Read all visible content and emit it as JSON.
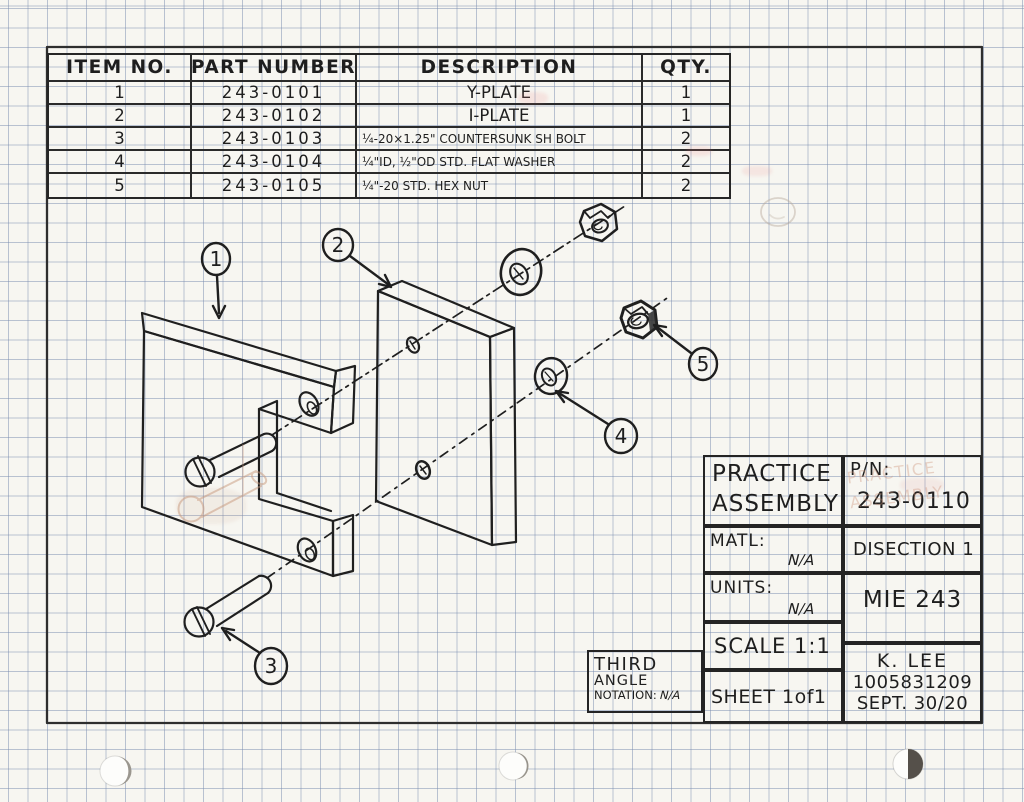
{
  "parts_table": {
    "headers": {
      "item": "ITEM NO.",
      "part": "PART NUMBER",
      "desc": "DESCRIPTION",
      "qty": "QTY."
    },
    "rows": [
      {
        "item": "1",
        "part": "243-0101",
        "desc": "Y-PLATE",
        "qty": "1"
      },
      {
        "item": "2",
        "part": "243-0102",
        "desc": "I-PLATE",
        "qty": "1"
      },
      {
        "item": "3",
        "part": "243-0103",
        "desc": "¼-20×1.25\" COUNTERSUNK SH BOLT",
        "qty": "2"
      },
      {
        "item": "4",
        "part": "243-0104",
        "desc": "¼\"ID, ½\"OD STD. FLAT WASHER",
        "qty": "2"
      },
      {
        "item": "5",
        "part": "243-0105",
        "desc": "¼\"-20 STD. HEX NUT",
        "qty": "2"
      }
    ]
  },
  "title_block": {
    "title_line1": "PRACTICE",
    "title_line2": "ASSEMBLY",
    "pn_label": "P/N:",
    "pn_value": "243-0110",
    "matl_label": "MATL:",
    "matl_value": "N/A",
    "section": "DISECTION 1",
    "units_label": "UNITS:",
    "units_value": "N/A",
    "course": "MIE 243",
    "scale": "SCALE 1:1",
    "sheet": "SHEET 1of1",
    "author": "K. LEE",
    "student_id": "1005831209",
    "date": "SEPT. 30/20",
    "ghost_line1": "PRACTICE",
    "ghost_line2": "ASSEMBLY"
  },
  "projection_box": {
    "line1": "THIRD",
    "line2": "ANGLE",
    "line3": "NOTATION:",
    "value": "N/A"
  },
  "balloons": [
    "1",
    "2",
    "3",
    "4",
    "5"
  ],
  "colors": {
    "ink": "#1f1f1f",
    "grid": "#7a8cb0",
    "paper": "#f7f6f1",
    "pencil_ghost": "#c89a7d"
  }
}
